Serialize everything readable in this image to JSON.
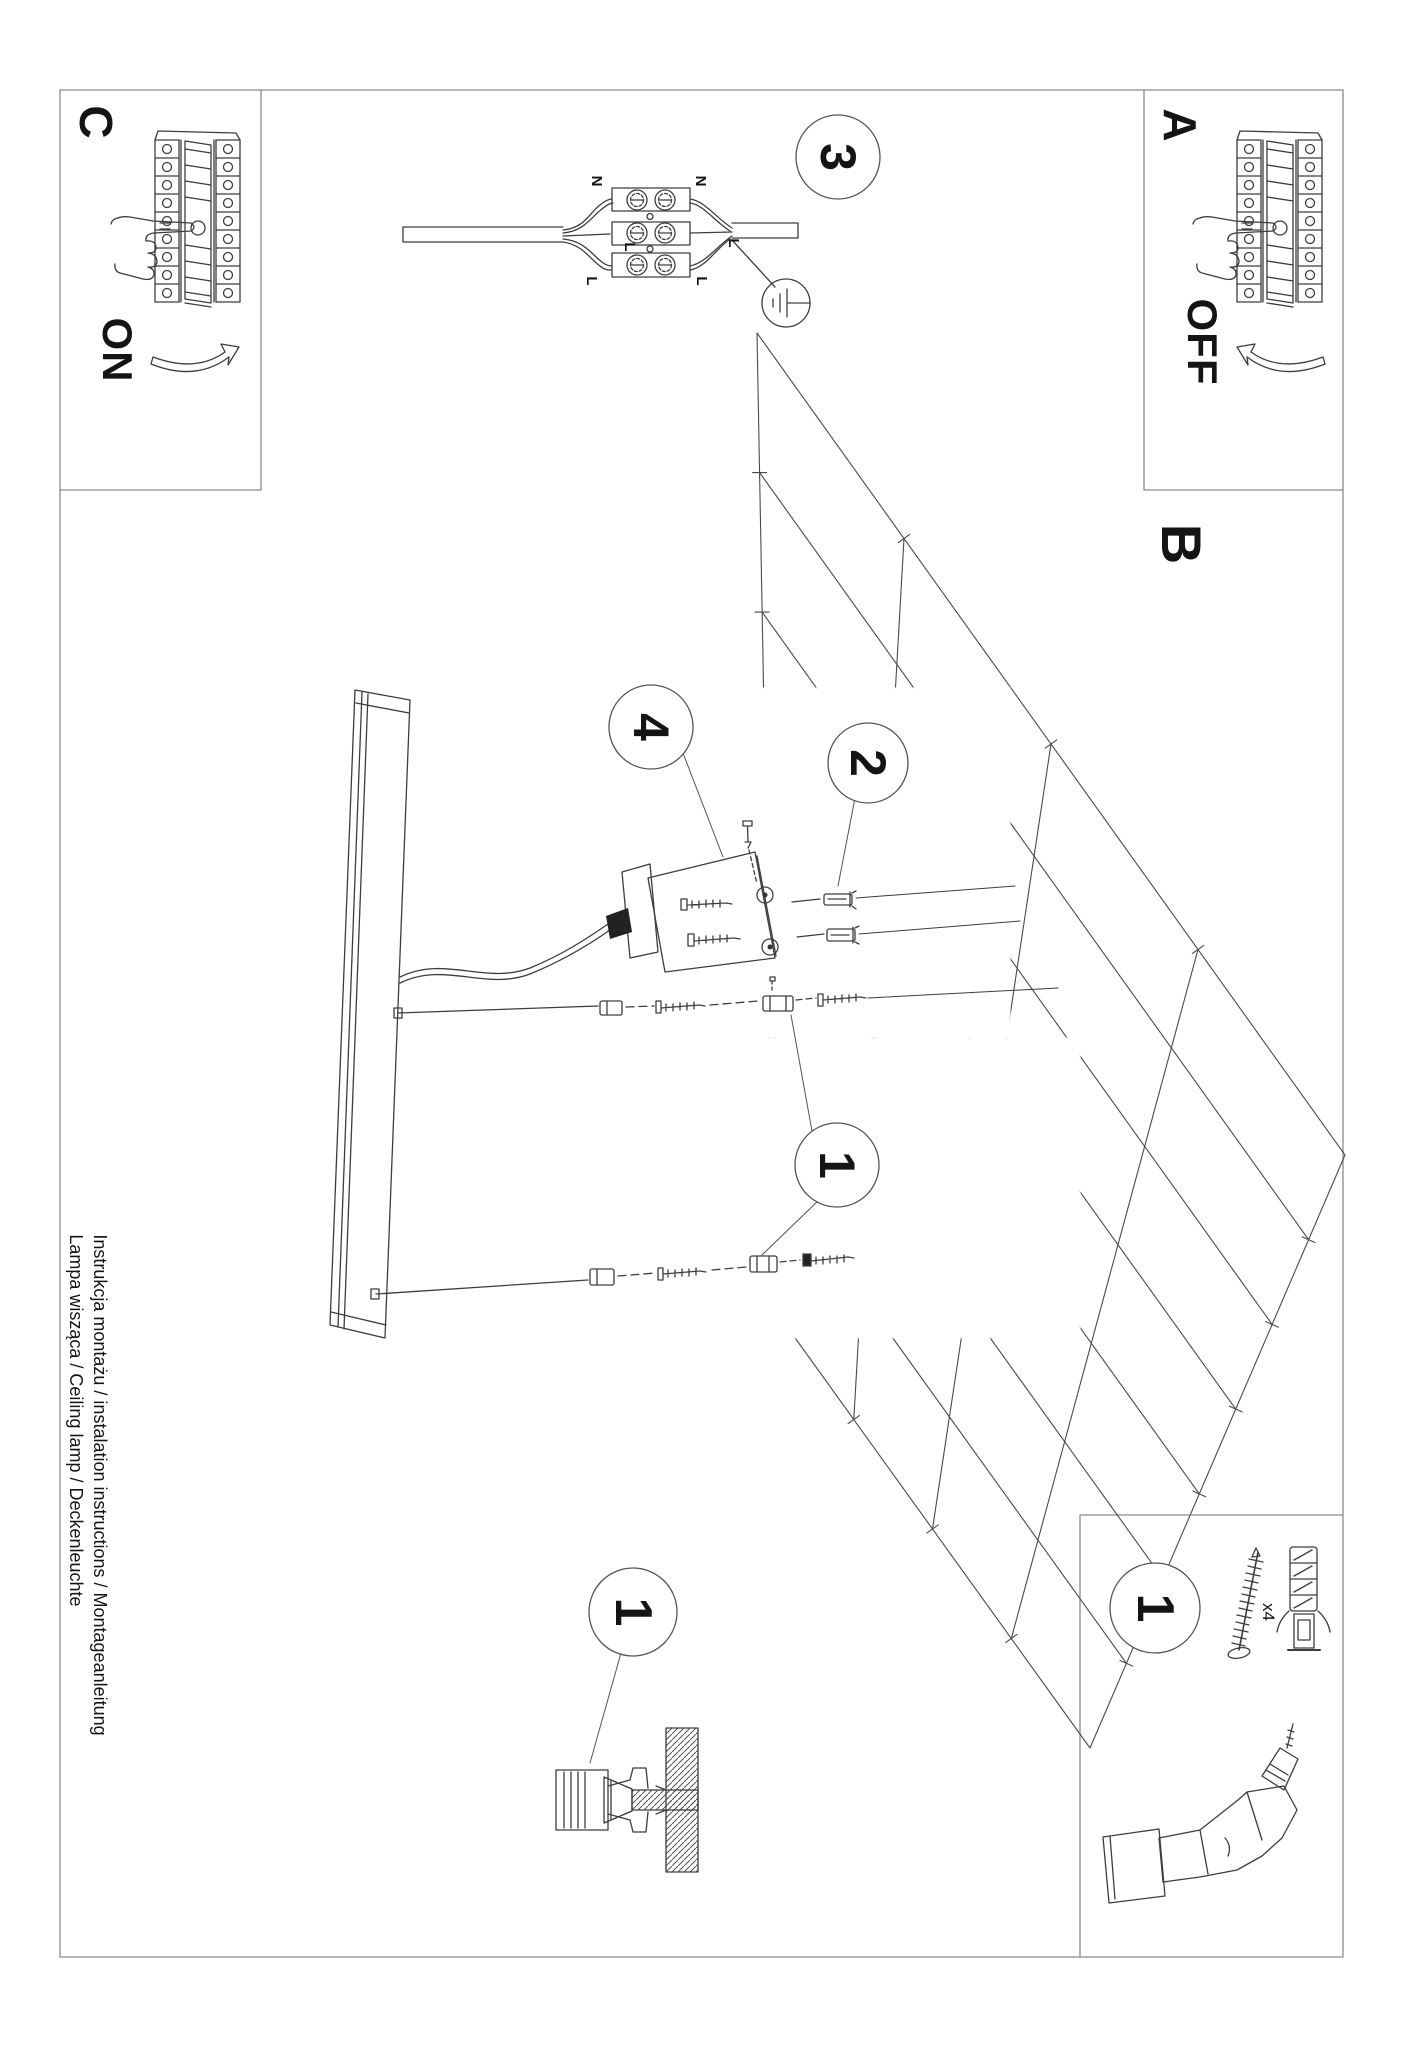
{
  "labels": {
    "step_a": "A",
    "step_b": "B",
    "step_c": "C",
    "switch_on": "ON",
    "switch_off": "OFF",
    "callout_1": "1",
    "callout_2": "2",
    "callout_3": "3",
    "callout_4": "4",
    "wire_n": "N",
    "wire_l": "L",
    "anchor_qty": "x4"
  },
  "footer": {
    "line1": "Instrukcja montażu / instalation instructions / Montageanleitung",
    "line2": "Lampa wisząca / Ceiling lamp / Deckenleuchte"
  },
  "colors": {
    "line": "#3d3d3d",
    "frame": "#8c8c8c",
    "text": "#141414",
    "background": "#ffffff"
  }
}
